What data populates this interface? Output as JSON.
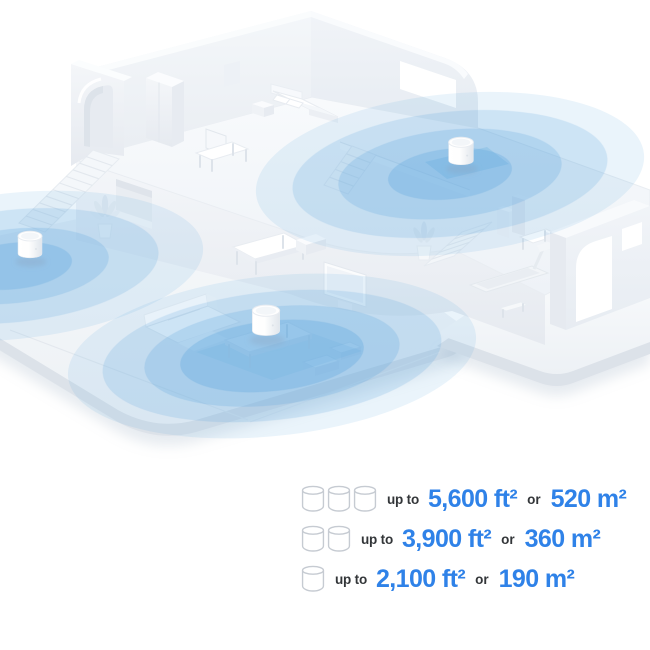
{
  "legend": {
    "rows": [
      {
        "units": 3,
        "prefix": "up to",
        "ft": "5,600 ft²",
        "conj": "or",
        "m": "520 m²"
      },
      {
        "units": 2,
        "prefix": "up to",
        "ft": "3,900 ft²",
        "conj": "or",
        "m": "360 m²"
      },
      {
        "units": 1,
        "prefix": "up to",
        "ft": "2,100 ft²",
        "conj": "or",
        "m": "190 m²"
      }
    ],
    "accent_color": "#2F82E8",
    "text_color": "#333639",
    "icon_outline_color": "#C6CBD2",
    "unit_icon": "mesh-router-cylinder"
  },
  "illustration": {
    "type": "isometric-home-wifi-coverage",
    "mesh_units_visible": 3,
    "coverage_rings_per_unit": 3,
    "coverage_color": "#5FA8E0"
  }
}
